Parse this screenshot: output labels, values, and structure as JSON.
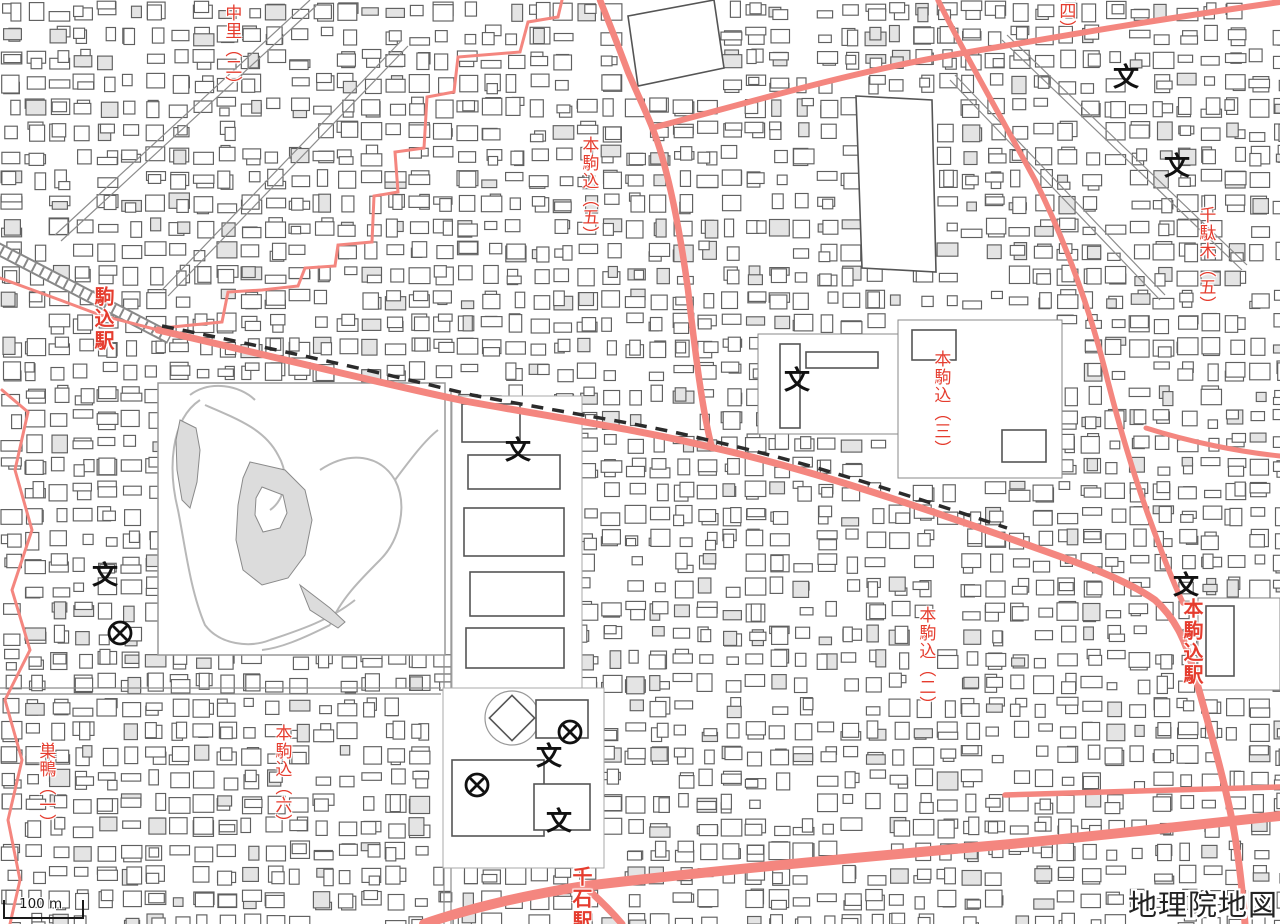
{
  "map": {
    "attribution": "地理院地図",
    "scale_bar": {
      "label": "100 m"
    },
    "labels": [
      {
        "id": "nakazato-2",
        "text": "中里（二）",
        "kind": "district",
        "x": 231,
        "y": 4
      },
      {
        "id": "komagome-station",
        "text": "駒込駅",
        "kind": "station",
        "x": 103,
        "y": 286
      },
      {
        "id": "honkomagome-5",
        "text": "本駒込（五）",
        "kind": "district",
        "x": 588,
        "y": 136
      },
      {
        "id": "district-4",
        "text": "（四）",
        "kind": "district",
        "x": 1065,
        "y": -16
      },
      {
        "id": "sendagi-5",
        "text": "千駄木（五）",
        "kind": "district",
        "x": 1205,
        "y": 206
      },
      {
        "id": "honkomagome-3",
        "text": "本駒込（三）",
        "kind": "district",
        "x": 940,
        "y": 350
      },
      {
        "id": "honkomagome-2",
        "text": "本駒込（二）",
        "kind": "district",
        "x": 925,
        "y": 606
      },
      {
        "id": "honkomagome-station",
        "text": "本駒込駅",
        "kind": "station",
        "x": 1192,
        "y": 598
      },
      {
        "id": "honkomagome-6",
        "text": "本駒込（六）",
        "kind": "district",
        "x": 281,
        "y": 724
      },
      {
        "id": "sugamo-1",
        "text": "巣鴨（一）",
        "kind": "district",
        "x": 45,
        "y": 742
      },
      {
        "id": "sengoku-station",
        "text": "千石駅",
        "kind": "station",
        "x": 581,
        "y": 866
      }
    ],
    "symbols": [
      {
        "kind": "school",
        "glyph": "文",
        "x": 518,
        "y": 451
      },
      {
        "kind": "school",
        "glyph": "文",
        "x": 105,
        "y": 576
      },
      {
        "kind": "school",
        "glyph": "文",
        "x": 797,
        "y": 381
      },
      {
        "kind": "school",
        "glyph": "文",
        "x": 1126,
        "y": 78
      },
      {
        "kind": "school",
        "glyph": "文",
        "x": 1177,
        "y": 167
      },
      {
        "kind": "school",
        "glyph": "文",
        "x": 1186,
        "y": 586
      },
      {
        "kind": "school",
        "glyph": "文",
        "x": 549,
        "y": 757
      },
      {
        "kind": "school",
        "glyph": "文",
        "x": 559,
        "y": 822
      },
      {
        "kind": "police_station",
        "x": 120,
        "y": 633
      },
      {
        "kind": "police_station",
        "x": 570,
        "y": 732
      },
      {
        "kind": "police_station",
        "x": 477,
        "y": 785
      }
    ],
    "colors": {
      "road": "#F4867F",
      "label_red": "#E53C2E",
      "building": "#5F5F5F",
      "water": "#DCDCDC",
      "rail": "#888888",
      "subway": "#2B2B2B"
    }
  }
}
